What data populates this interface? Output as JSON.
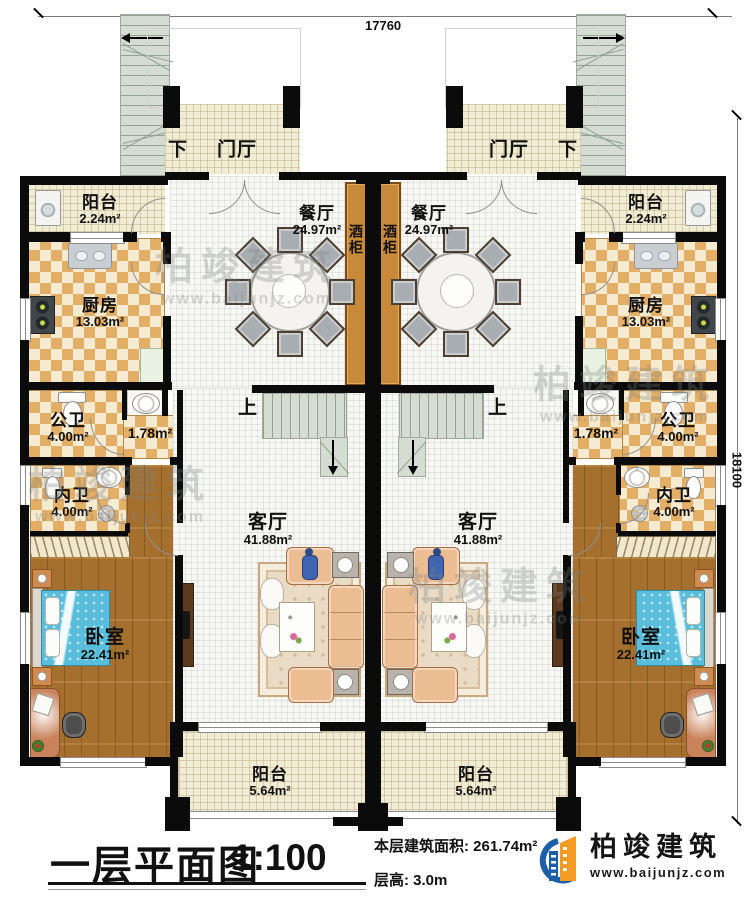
{
  "dimensions": {
    "top": "17760",
    "right": "18100"
  },
  "labels": {
    "foyer": "门厅",
    "down": "下",
    "up": "上",
    "balcony": "阳台",
    "balcony_top_area": "2.24m²",
    "dining": "餐厅",
    "dining_area": "24.97m²",
    "wine_cabinet": "酒柜",
    "kitchen": "厨房",
    "kitchen_area": "13.03m²",
    "public_bath": "公卫",
    "public_bath_area": "4.00m²",
    "washroom_area": "1.78m²",
    "private_bath": "内卫",
    "private_bath_area": "4.00m²",
    "living": "客厅",
    "living_area": "41.88m²",
    "bedroom": "卧室",
    "bedroom_area": "22.41m²",
    "balcony_bottom_area": "5.64m²"
  },
  "title_block": {
    "title": "一层平面图",
    "scale": "1:100",
    "floor_area_label": "本层建筑面积:",
    "floor_area_value": "261.74m²",
    "floor_height_label": "层高:",
    "floor_height_value": "3.0m"
  },
  "logo": {
    "company": "柏竣建筑",
    "website": "www.baijunjz.com"
  },
  "watermark": {
    "text": "柏竣建筑",
    "url": "www.baijunjz.com"
  },
  "colors": {
    "wall": "#0b0b0b",
    "wood_floor": "#a5702e",
    "checker_tile": "#e3ae66",
    "cream_tile": "#f1ecd4",
    "stair": "#d5ddd3",
    "wine_cabinet": "#c9893b",
    "bed": "#58bedb",
    "sofa": "#ecbd93",
    "logo_blue": "#1c5fa8",
    "logo_orange": "#f59a23"
  }
}
